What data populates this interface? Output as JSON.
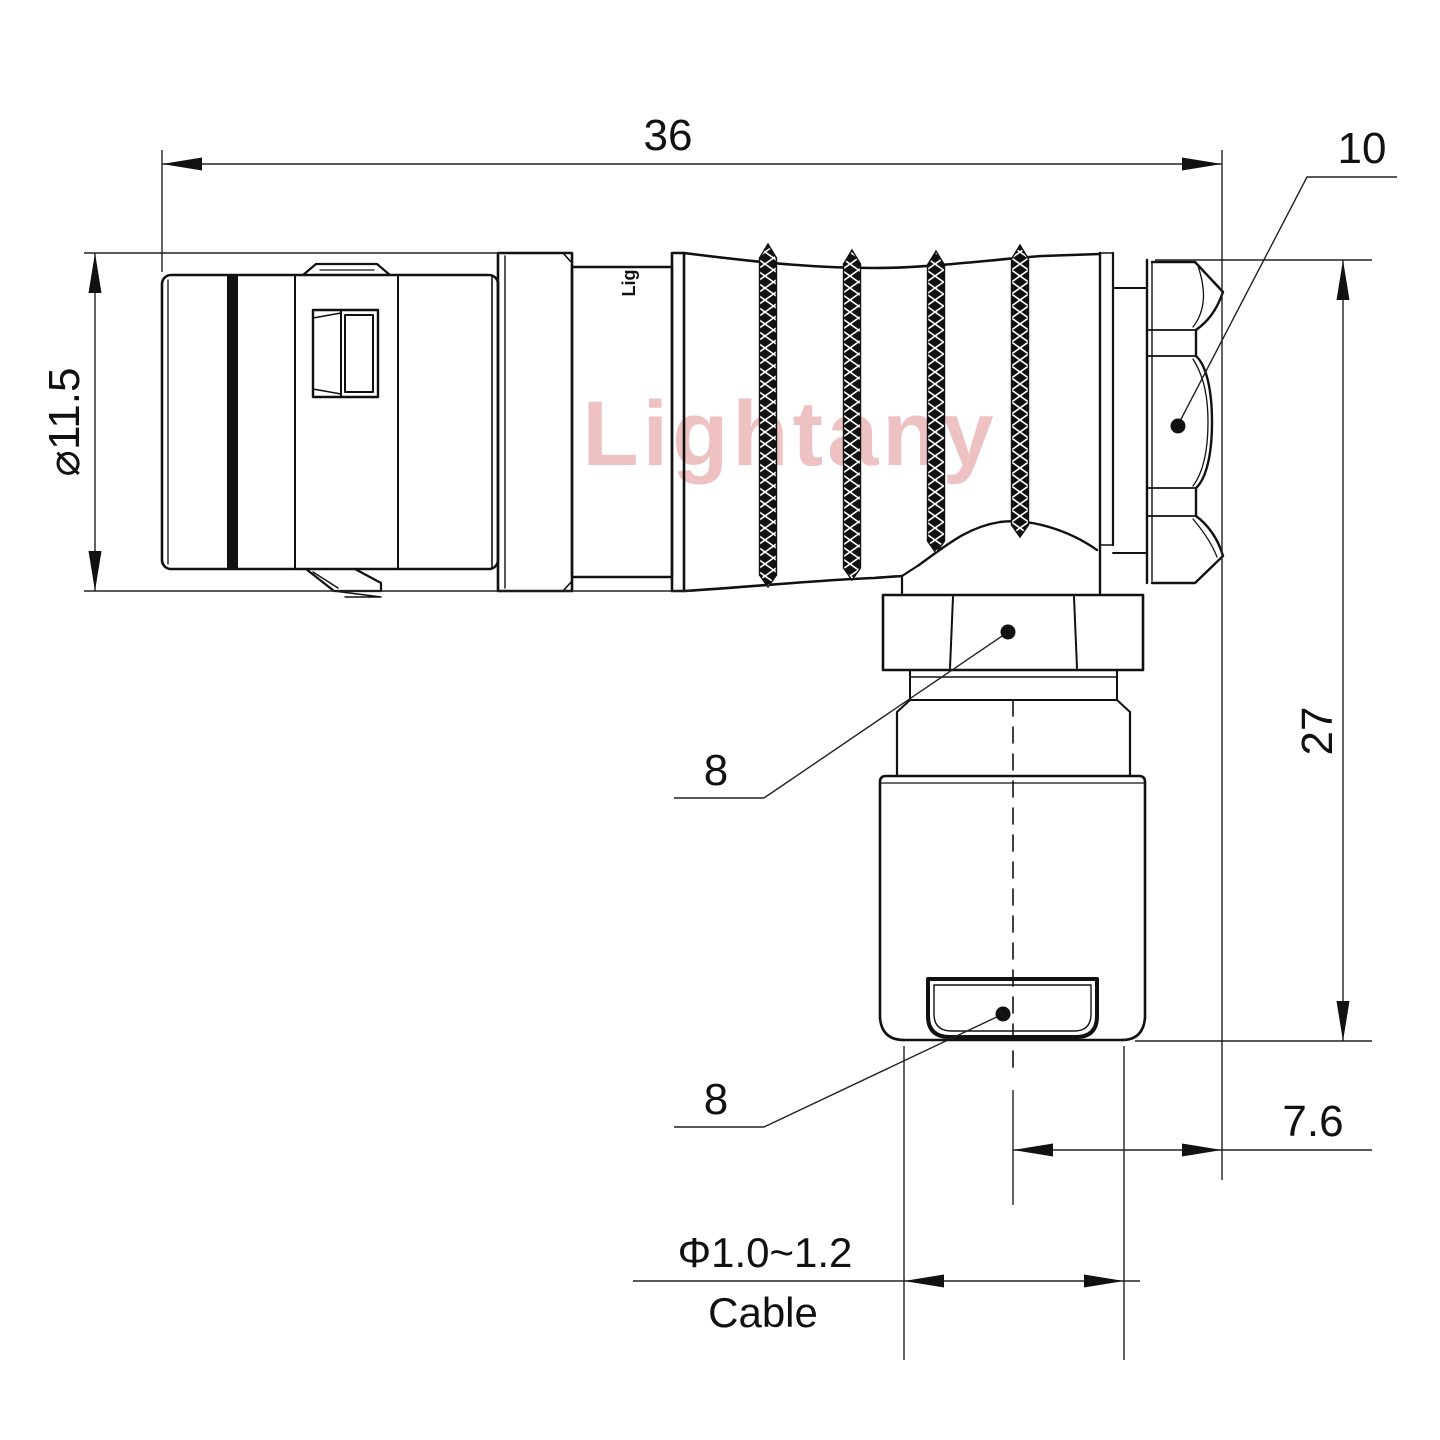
{
  "watermark": "Lightany",
  "logo_mark": "Lig",
  "colors": {
    "line": "#111111",
    "dimension": "#222222",
    "watermark_pink": "#eec2c2",
    "background": "#ffffff"
  },
  "dims": {
    "overall_length": "36",
    "coupling_nut": "10",
    "shell_diameter": "⌀11.5",
    "elbow_height": "27",
    "backnut_hex": "8",
    "gland_hex": "8",
    "axis_to_face": "7.6",
    "cable_diameter": "Φ1.0~1.2",
    "cable_label": "Cable"
  }
}
